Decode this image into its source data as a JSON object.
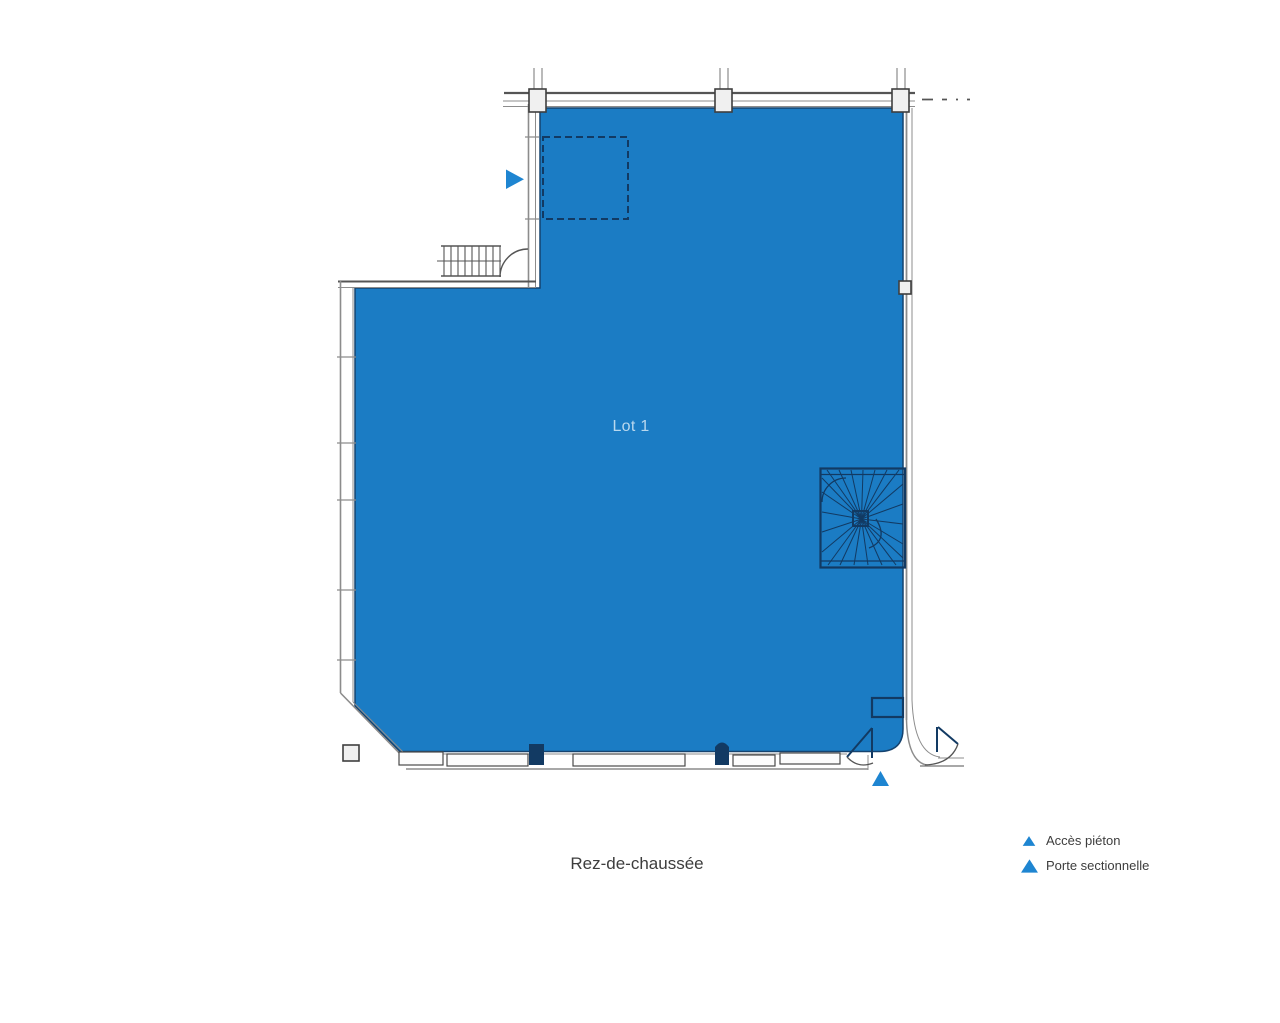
{
  "plan": {
    "lot_label": "Lot 1",
    "caption": "Rez-de-chaussée"
  },
  "legend": {
    "items": [
      {
        "label": "Accès piéton",
        "marker_icon": "triangle-small-blue"
      },
      {
        "label": "Porte sectionnelle",
        "marker_icon": "triangle-large-blue"
      }
    ]
  },
  "colors": {
    "lot_fill": "#1b7cc4",
    "lot_edge": "#15436f",
    "lot_label_text": "#b9d8ee",
    "marker": "#1e85d1",
    "interior_lines": "#123a63",
    "wall_gray": "#8c8c8c",
    "text": "#3d3d3d",
    "background": "#ffffff"
  }
}
